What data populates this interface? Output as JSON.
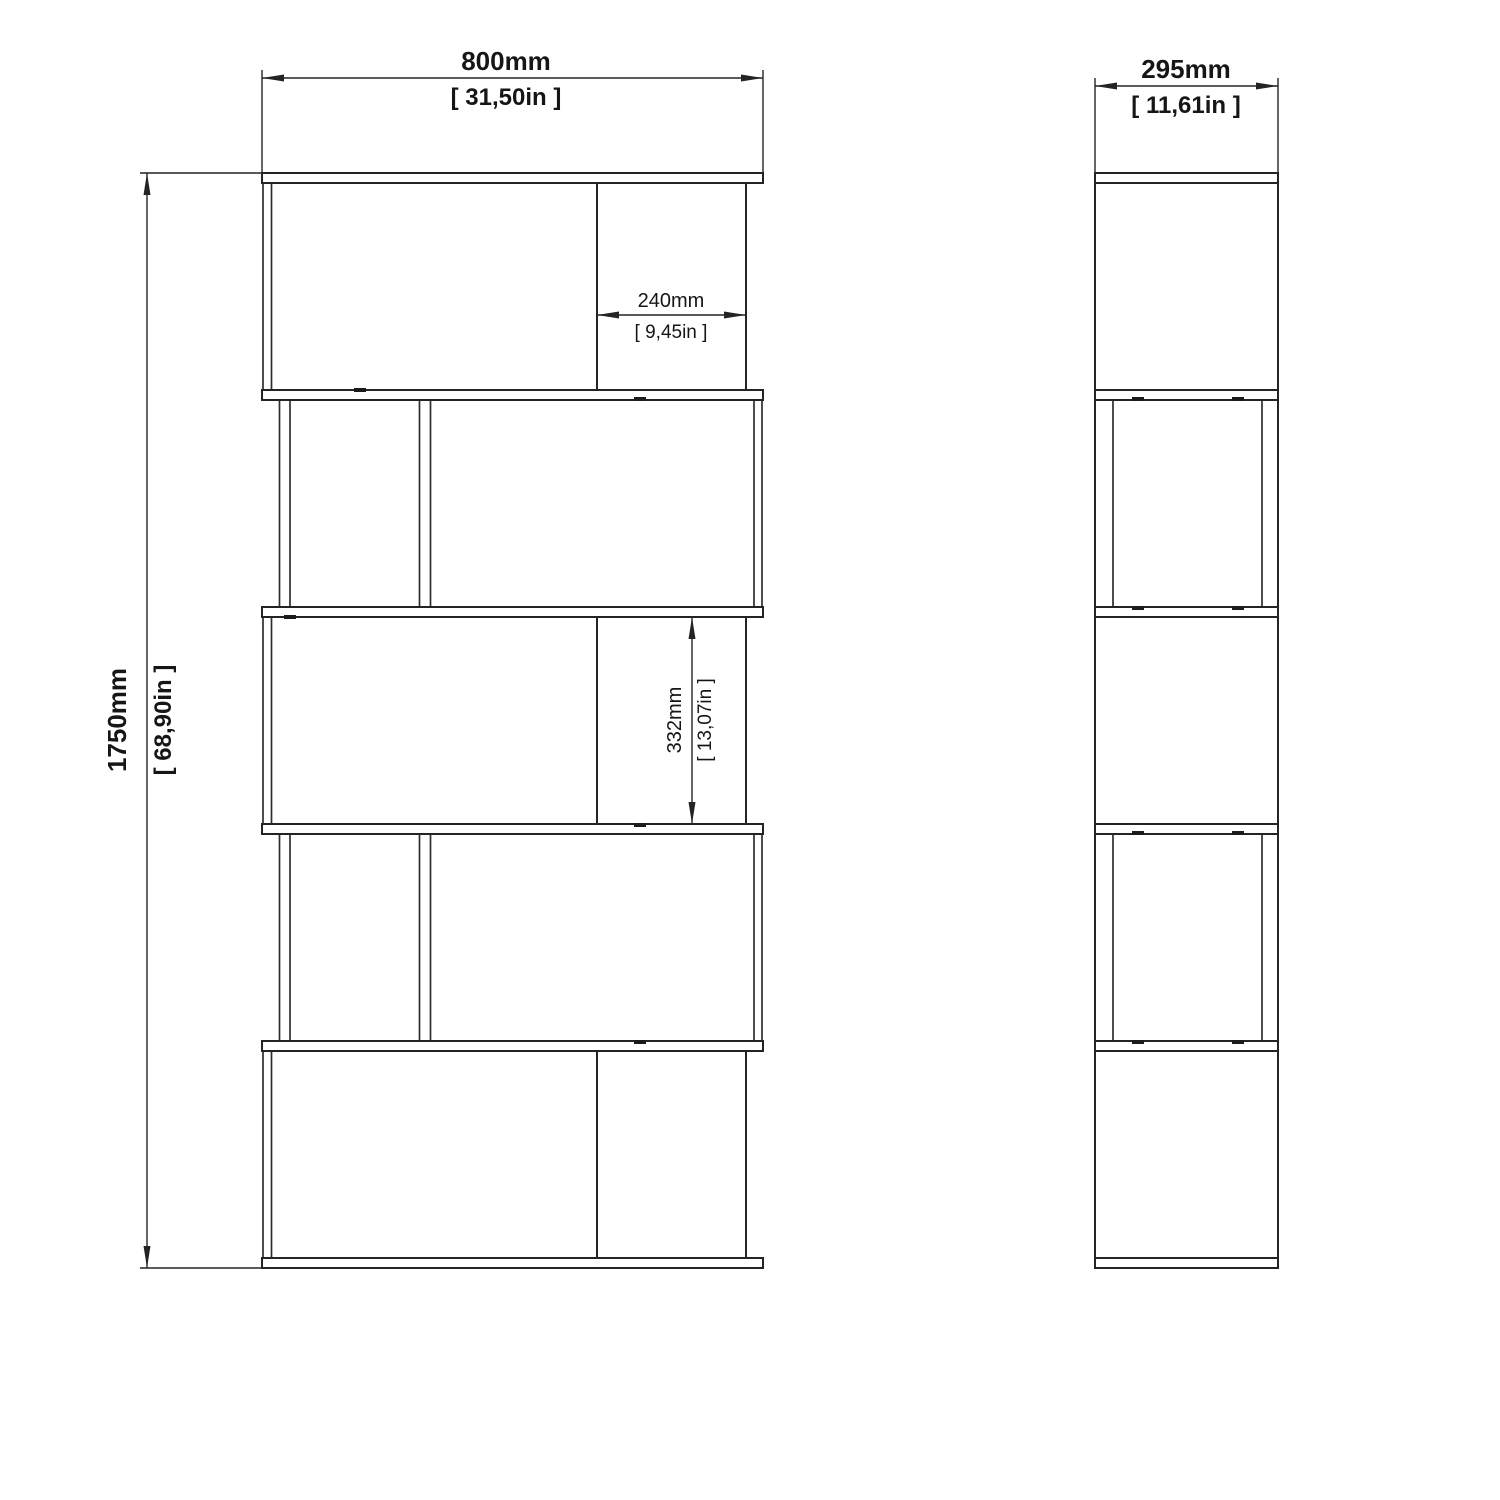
{
  "page": {
    "background": "#ffffff",
    "line_color": "#242424",
    "text_color": "#161616",
    "description": "Technical dimension drawing of a 5-tier zig-zag open bookcase, front view and side view"
  },
  "views": {
    "front": {
      "label": "front-view"
    },
    "side": {
      "label": "side-view"
    }
  },
  "dimensions": {
    "width": {
      "mm": "800mm",
      "inches": "[ 31,50in ]"
    },
    "depth": {
      "mm": "295mm",
      "inches": "[ 11,61in ]"
    },
    "height": {
      "mm": "1750mm",
      "inches": "[ 68,90in ]"
    },
    "compartment_width": {
      "mm": "240mm",
      "inches": "[ 9,45in ]"
    },
    "compartment_height": {
      "mm": "332mm",
      "inches": "[ 13,07in ]"
    }
  }
}
